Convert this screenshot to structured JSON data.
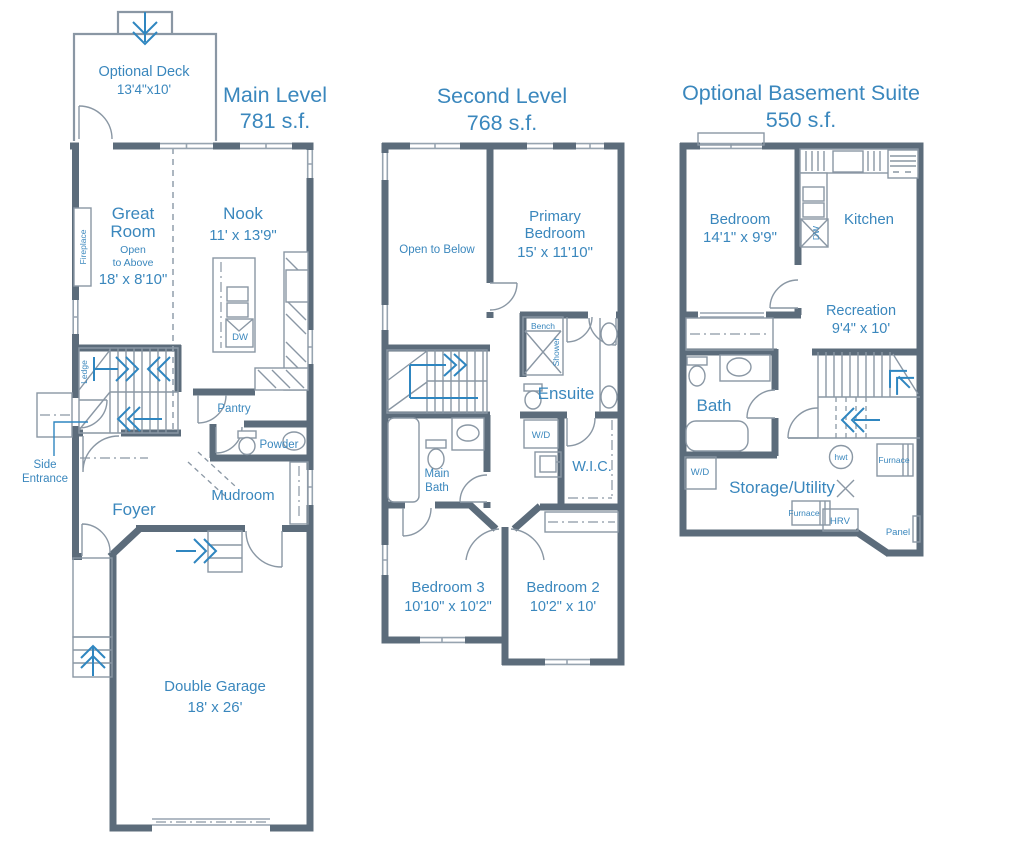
{
  "colors": {
    "accent": "#3a87bd",
    "wall": "#5c6c7b",
    "line": "#8a97a4",
    "arrow_blue": "#2f86c0"
  },
  "plans": {
    "main": {
      "title": "Main Level",
      "area": "781 s.f.",
      "deck": {
        "name": "Optional Deck",
        "dims": "13'4\"x10'"
      },
      "great_room": {
        "line1": "Great",
        "line2": "Room",
        "note1": "Open",
        "note2": "to Above",
        "dims": "18' x 8'10\""
      },
      "nook": {
        "name": "Nook",
        "dims": "11' x 13'9\""
      },
      "labels": {
        "fireplace": "Fireplace",
        "ledge": "Ledge",
        "side1": "Side",
        "side2": "Entrance",
        "pantry": "Pantry",
        "powder": "Powder",
        "dw": "DW",
        "foyer": "Foyer",
        "mudroom": "Mudroom"
      },
      "garage": {
        "name": "Double Garage",
        "dims": "18' x 26'"
      }
    },
    "second": {
      "title": "Second Level",
      "area": "768 s.f.",
      "labels": {
        "open_to_below": "Open to Below",
        "bench": "Bench",
        "shower": "Shower",
        "ensuite": "Ensuite",
        "wd": "W/D",
        "wic": "W.I.C.",
        "main_bath1": "Main",
        "main_bath2": "Bath"
      },
      "primary": {
        "line1": "Primary",
        "line2": "Bedroom",
        "dims": "15' x 11'10\""
      },
      "bedroom3": {
        "name": "Bedroom 3",
        "dims": "10'10\" x 10'2\""
      },
      "bedroom2": {
        "name": "Bedroom 2",
        "dims": "10'2\" x 10'"
      }
    },
    "basement": {
      "title": "Optional Basement Suite",
      "area": "550 s.f.",
      "bedroom": {
        "name": "Bedroom",
        "dims": "14'1\" x 9'9\""
      },
      "recreation": {
        "name": "Recreation",
        "dims": "9'4\" x 10'"
      },
      "labels": {
        "kitchen": "Kitchen",
        "dw": "DW",
        "bath": "Bath",
        "wd": "W/D",
        "storage": "Storage/Utility",
        "hwt": "hwt",
        "furnace1": "Furnace",
        "furnace2": "Furnace",
        "hrv": "HRV",
        "panel": "Panel"
      }
    }
  }
}
